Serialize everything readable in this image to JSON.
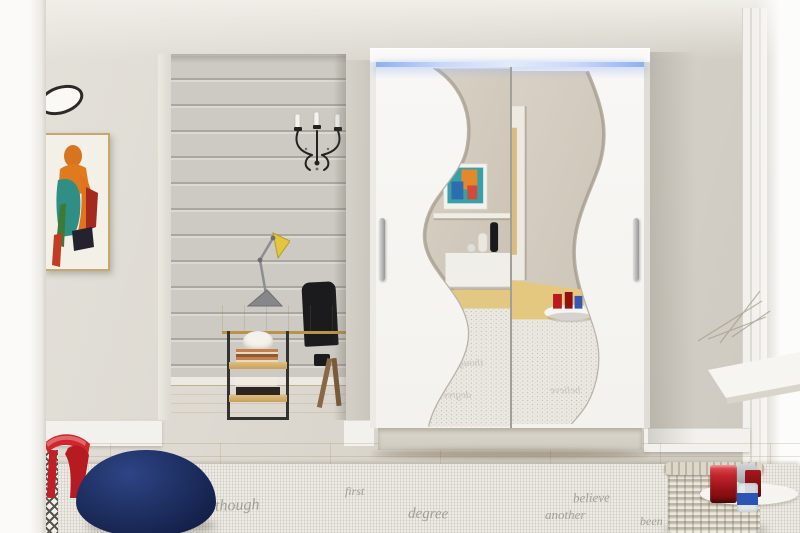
{
  "image": {
    "type": "interior product photograph",
    "subject": "White two-door sliding wardrobe with wavy mirror fronts and blue LED top lighting, styled in a bright room with desk nook, art, rug and accessories"
  },
  "palette": {
    "wall": "#d8d4cb",
    "alcove_wall": "#cdcac3",
    "wood_floor": "#e2c57e",
    "rug": "#edebe4",
    "wardrobe_white": "#f7f6f3",
    "led_blue": "#8fb0ef",
    "mirror_tint": "#d2cabd",
    "pouf_navy": "#1c2a5c",
    "stool_red": "#cd2127",
    "candle_red": "#b41318",
    "basket_wicker": "#d6cfc0",
    "frame_gold": "#c7a76d",
    "art_orange": "#e0731c",
    "art_teal": "#2f8f85",
    "lamp_yellow": "#e3c63f"
  },
  "wardrobe": {
    "doors": "2",
    "handles": "2",
    "mirror_style": "wave-shaped mirror inserts",
    "lighting": "blue LED strip under top panel"
  },
  "rug": {
    "words": [
      "though",
      "first",
      "degree",
      "another",
      "believe",
      "been"
    ]
  }
}
